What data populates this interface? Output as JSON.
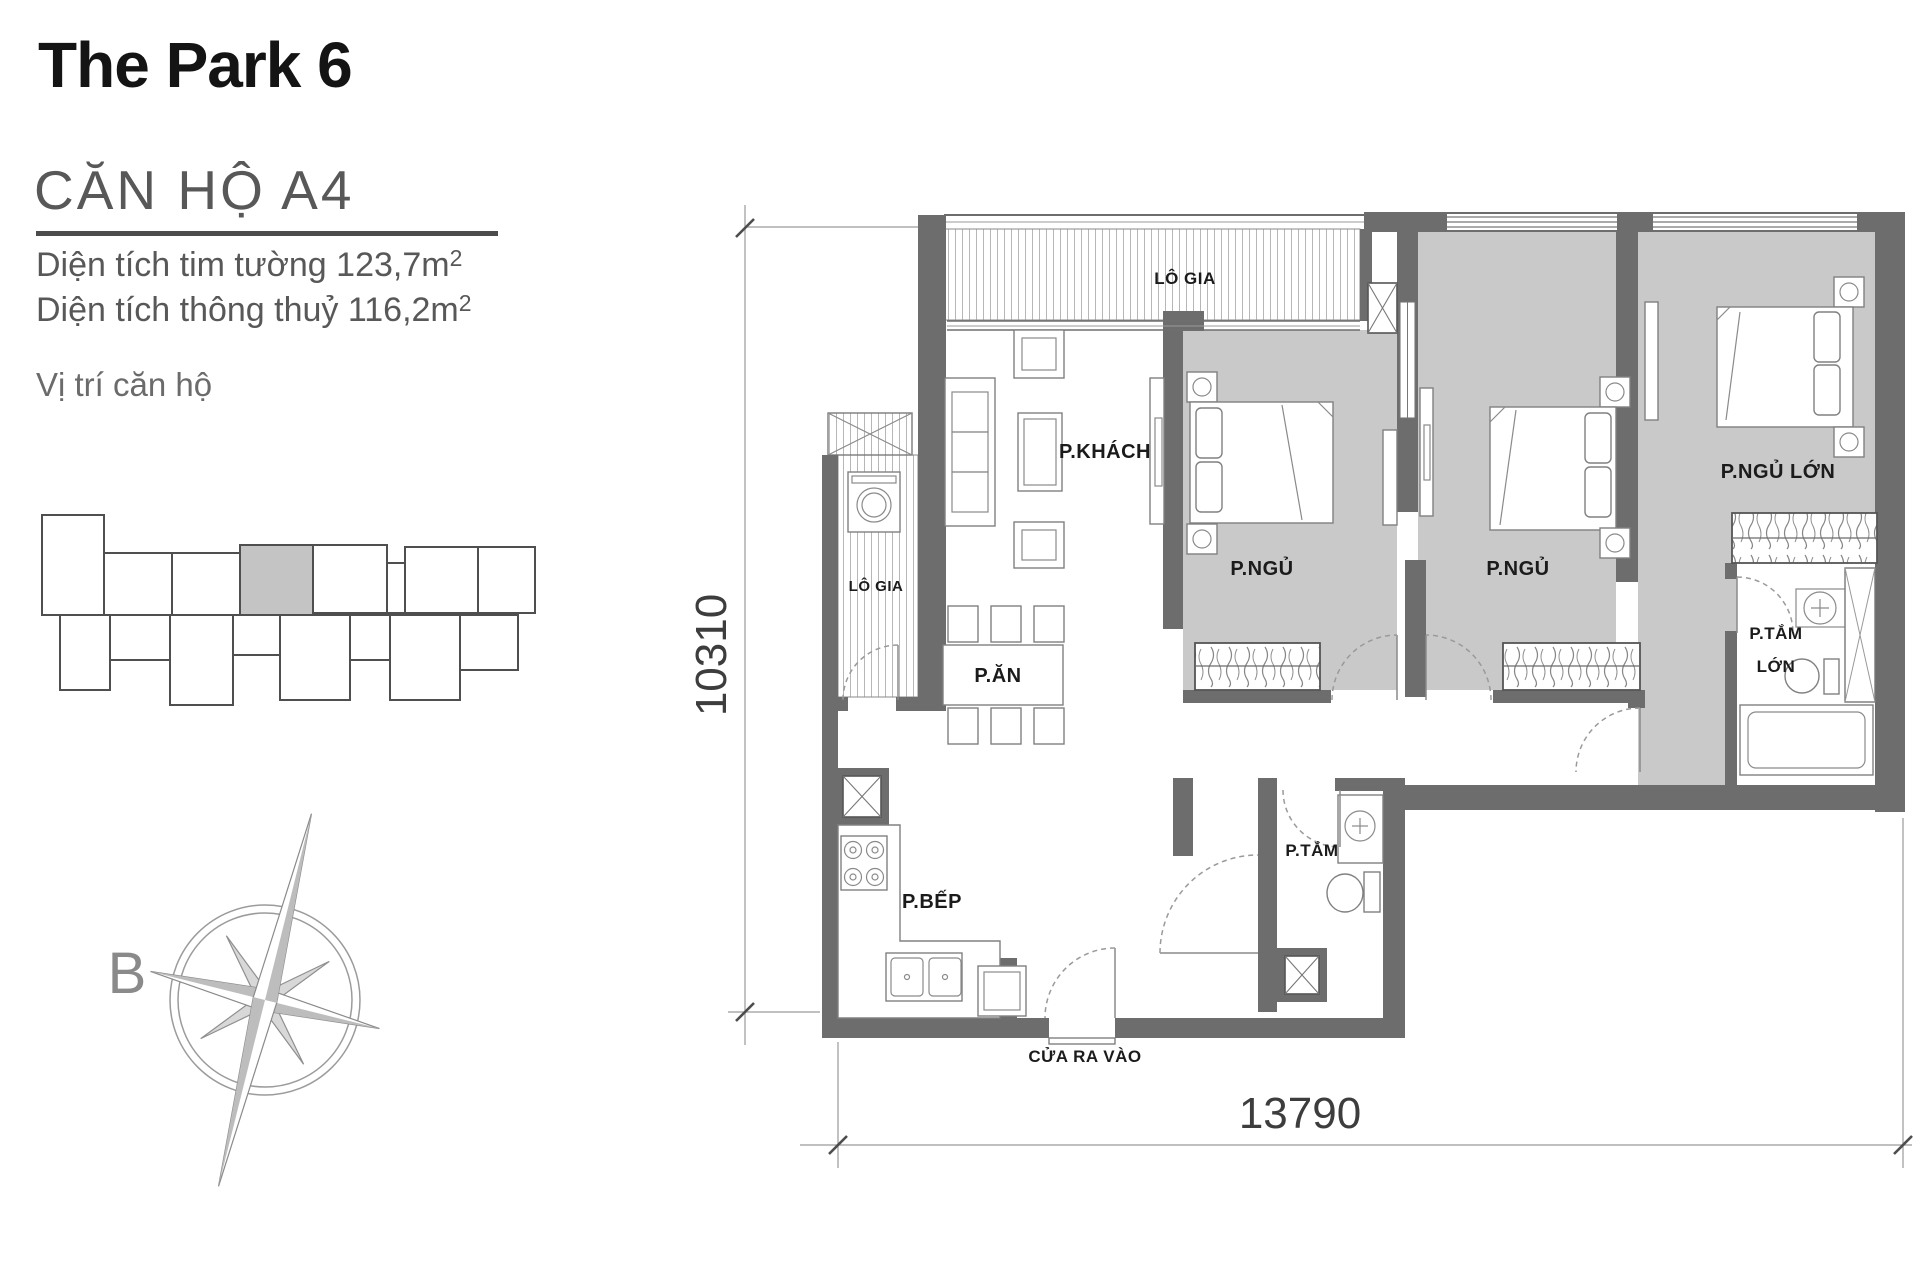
{
  "title": "The Park 6",
  "unit": {
    "name": "CĂN HỘ A4"
  },
  "areas": {
    "line1": {
      "text": "Diện tích tim tường 123,7m",
      "sup": "2"
    },
    "line2": {
      "text": "Diện tích thông thuỷ 116,2m",
      "sup": "2"
    }
  },
  "location_label": "Vị trí căn hộ",
  "compass": {
    "label": "B"
  },
  "plan": {
    "labels": {
      "balcony_top": "LÔ GIA",
      "living": "P.KHÁCH",
      "bedroom1": "P.NGỦ",
      "bedroom2": "P.NGỦ",
      "master_bedroom": "P.NGỦ LỚN",
      "master_bath1": "P.TẮM",
      "master_bath2": "LỚN",
      "balcony_side": "LÔ GIA",
      "dining": "P.ĂN",
      "kitchen": "P.BẾP",
      "bathroom": "P.TẮM",
      "entrance": "CỬA RA VÀO"
    },
    "dims": {
      "vertical": "10310",
      "horizontal": "13790"
    },
    "colors": {
      "wall": "#6d6d6d",
      "bedroom_floor": "#c9c9c9",
      "highlight_unit": "#c4c4c4"
    }
  }
}
